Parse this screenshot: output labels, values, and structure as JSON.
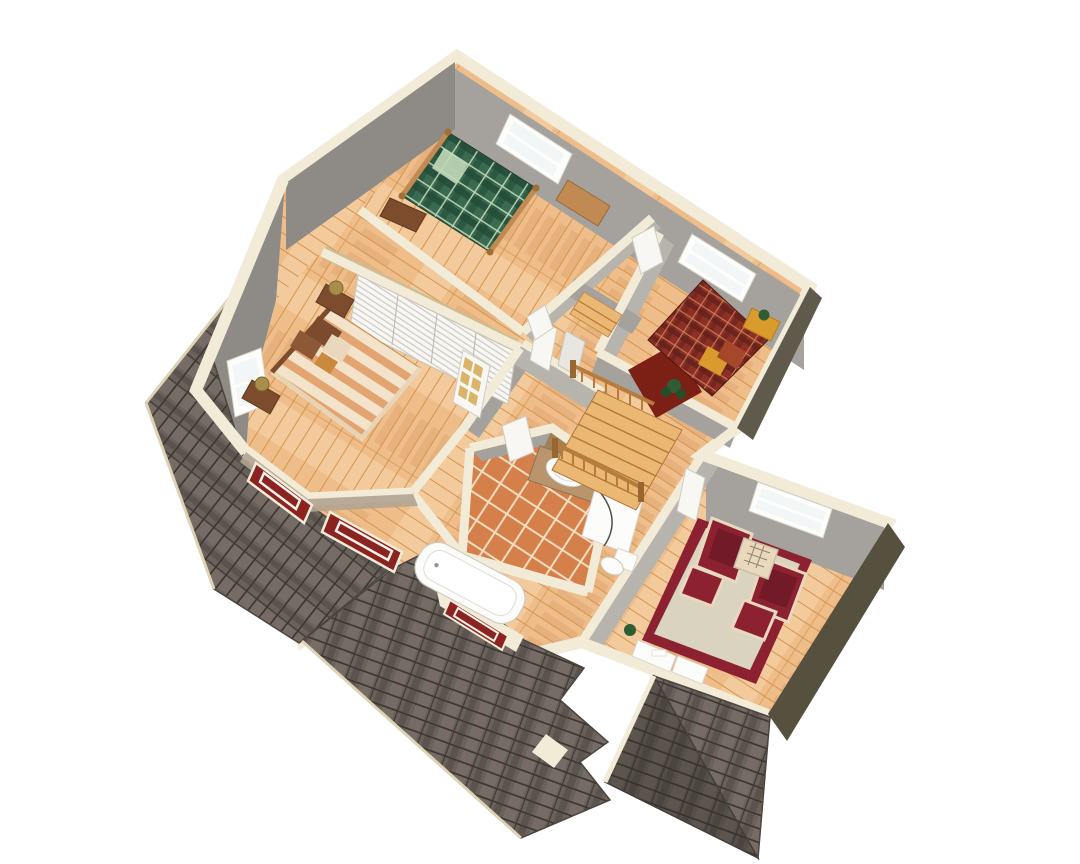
{
  "title": "3D cutaway second-floor house plan rendering",
  "colors": {
    "bg": "#ffffff",
    "wall_cream": "#f1ebd8",
    "wall_cream_shade": "#ddd2b6",
    "wall_gray": "#a5a29d",
    "wall_gray_light": "#b7b4ae",
    "wall_gray_dark": "#8e8b86",
    "wall_dark": "#56513f",
    "wall_dark2": "#5f5a4c",
    "floor_wood": "#eebd8a",
    "wood_line": "#d4954f",
    "wood_light": "#f7d8ab",
    "wood_shade": "#c98a4a",
    "tile": "#d5804b",
    "tile_grout": "#f2ddc0",
    "roof_base": "#6a615b",
    "roof_light": "#857a71",
    "roof_dark": "#4c453f",
    "shingle_gap": "#3b3631",
    "plaid_green": "#3a6b51",
    "plaid_green_dark": "#234c38",
    "plaid_green_line": "#c2d8b8",
    "plaid_red": "#8e2f26",
    "plaid_red_dark": "#62201a",
    "plaid_red_line": "#c97f55",
    "rug_dark_red": "#7c1f14",
    "stripe_a": "#e2a470",
    "stripe_b": "#f4e3cb",
    "pillow_brown": "#7c4a2c",
    "pillow_cream": "#e9d8bd",
    "chair_red": "#8c2231",
    "rug_field": "#dad3bf",
    "rug_border": "#8c2231",
    "stair_wood": "#eab873",
    "stair_shade": "#b5773b",
    "railing": "#b67c3e",
    "railing_dark": "#9a6630",
    "brass": "#a78e4c",
    "wood_dark": "#7c4c2c",
    "wood_mid": "#c08a52",
    "door_white": "#f8f7f3",
    "frame_white": "#fdfdfb",
    "pane": "#f2f6f6",
    "pane_gold": "#d9b469",
    "counter_tan": "#b9946c",
    "mirror_tan": "#a08058",
    "fixture_white": "#fcfcfa",
    "bay_red": "#8b2420",
    "stone": "#b3a492",
    "plant_green": "#2f5c33",
    "soffit_tan": "#cdbd92",
    "gold": "#d99b2b"
  },
  "scene": {
    "style": "isometric-cutaway-3d-floorplan",
    "roof": "dark-gray-asphalt-shingles",
    "floors": [
      "light-oak-hardwood",
      "terracotta-tile-bathroom"
    ],
    "rooms": [
      {
        "name": "bedroom-green",
        "furniture": [
          "green-plaid-bed-wood-frame",
          "desk",
          "nightstand"
        ],
        "windows": 1
      },
      {
        "name": "bedroom-red",
        "furniture": [
          "red-plaid-bed",
          "gold-pillows",
          "dark-red-rug",
          "potted-plant",
          "bench-with-plant"
        ],
        "windows": 1
      },
      {
        "name": "master-bedroom",
        "furniture": [
          "striped-bed",
          "brown-pillows",
          "nightstand-with-brass-lamp",
          "nightstand-with-brass-lamp",
          "louvered-closet"
        ],
        "windows": [
          "side-window",
          "bay-window-2-lites"
        ]
      },
      {
        "name": "bathroom",
        "furniture": [
          "bathtub-in-alcove",
          "vanity-with-oval-sink",
          "shower-stall",
          "toilet"
        ],
        "windows": [
          "alcove-window"
        ]
      },
      {
        "name": "hallway",
        "furniture": [
          "staircase-down",
          "wood-railing-balusters",
          "attic-steps",
          "doors",
          "french-door-gold-panes"
        ]
      },
      {
        "name": "sitting-room",
        "furniture": [
          "red-armchair",
          "red-armchair",
          "ottoman",
          "ottoman",
          "lattice-side-table",
          "bordered-area-rug",
          "low-shelf",
          "plant"
        ],
        "windows": 1
      }
    ]
  }
}
